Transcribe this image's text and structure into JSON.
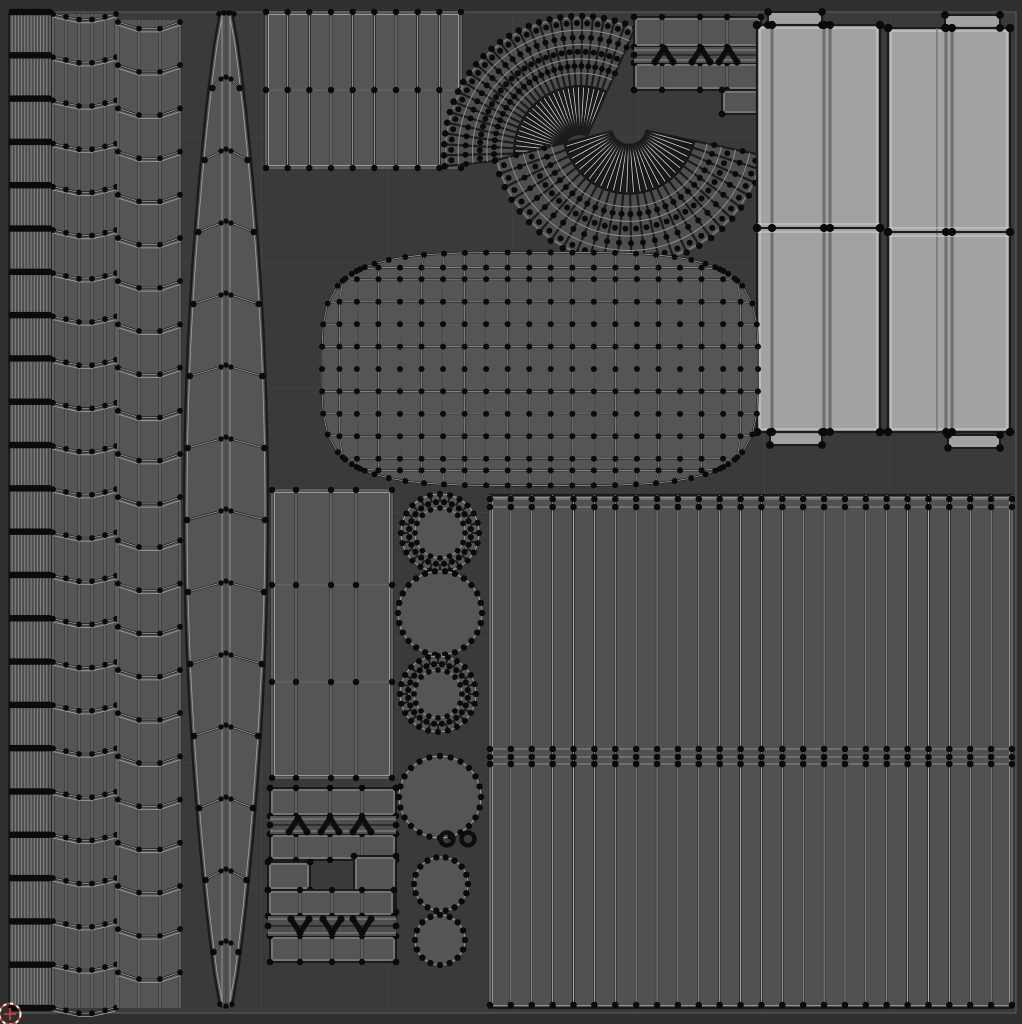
{
  "view": {
    "width": 1022,
    "height": 1024,
    "kind": "uv-editor-wireframe-viewport"
  },
  "colors": {
    "bg_outer": "#2f2f2f",
    "bg_uv": "#3a3a3a",
    "grid": "#414141",
    "uv_border": "#5e5e5e",
    "fill": "#555555",
    "fill_dim": "#4e4e4e",
    "fill_light": "#a2a2a2",
    "wire_light": "#a3a3a3",
    "wire_faint": "#8b8b8b",
    "wire_dark": "#1b1b1b",
    "vertex": "#0a0a0a",
    "band_black": "#0b0b0b",
    "fan_black": "#151515",
    "slit_light": "#d6d6d6",
    "cursor_red": "#cf3b3b",
    "cursor_white": "#efefef"
  },
  "grid": {
    "divisions": 8,
    "x": 10,
    "y": 12,
    "w": 1006,
    "h": 1001
  },
  "cursor": {
    "x": 10,
    "y": 1014,
    "r": 10.5
  },
  "islands": [
    {
      "name": "uv-island-strip-dense",
      "type": "dense_strip",
      "x": 9,
      "y": 12,
      "w": 41,
      "h": 996,
      "vlines": 12,
      "bands": 24
    },
    {
      "name": "uv-island-strip-chevron-a",
      "type": "chevron_strip",
      "y": 14,
      "h": 994,
      "cols": [
        53,
        66,
        79,
        92,
        105,
        116
      ],
      "rows": 24,
      "pitch": 43.2,
      "dip": 7,
      "off": 0
    },
    {
      "name": "uv-island-strip-chevron-b",
      "type": "chevron_strip",
      "y": 20,
      "h": 988,
      "cols": [
        118,
        139,
        160,
        180
      ],
      "rows": 23,
      "pitch": 43.2,
      "dip": 10,
      "off": 2
    },
    {
      "name": "uv-island-blade",
      "type": "blade",
      "cx": 226,
      "top": 12,
      "bottom": 1006,
      "maxHW": 42,
      "rows": 13
    },
    {
      "name": "uv-island-block-top",
      "type": "grid_block",
      "x": 266,
      "y": 12,
      "w": 195,
      "h": 156,
      "colCount": 10,
      "rowYs": [
        12,
        90,
        168
      ]
    },
    {
      "name": "uv-island-fan-upper",
      "type": "fan",
      "cx": 580,
      "cy": 152,
      "rIn": 17,
      "rOut": 136,
      "a1": -186,
      "a2": -66,
      "spokes": 26
    },
    {
      "name": "uv-island-fan-lower",
      "type": "fan",
      "cx": 629,
      "cy": 127,
      "rIn": 17,
      "rOut": 138,
      "a1": 12,
      "a2": 166,
      "spokes": 26
    },
    {
      "name": "uv-island-arrow-cluster-top",
      "type": "arrow_cluster",
      "cells": [
        {
          "x": 634,
          "y": 17,
          "w": 127,
          "h": 30,
          "v": [
            662,
            700,
            727
          ]
        },
        {
          "x": 634,
          "y": 63,
          "w": 127,
          "h": 27,
          "v": [
            662,
            700,
            727
          ]
        },
        {
          "x": 722,
          "y": 90,
          "w": 40,
          "h": 24,
          "v": []
        }
      ],
      "bands": [
        {
          "x": 634,
          "y": 47,
          "w": 127,
          "h": 16,
          "arrows": [
            664,
            701,
            728
          ],
          "dir": "up"
        }
      ]
    },
    {
      "name": "uv-island-panel-group-left",
      "type": "panels",
      "x": 757,
      "y": 25,
      "w": 123,
      "h": 407,
      "div": 228,
      "cols": [
        [
          772,
          1
        ],
        [
          824,
          1
        ],
        [
          830,
          1
        ]
      ],
      "capT": [
        768,
        12,
        54,
        13
      ],
      "capB": [
        770,
        432,
        52,
        13
      ]
    },
    {
      "name": "uv-island-panel-group-right",
      "type": "panels",
      "x": 888,
      "y": 28,
      "w": 122,
      "h": 404,
      "div": 232,
      "cols": [
        [
          937,
          0
        ],
        [
          946,
          1
        ],
        [
          952,
          1
        ]
      ],
      "capT": [
        945,
        15,
        55,
        13
      ],
      "capB": [
        948,
        435,
        52,
        13
      ]
    },
    {
      "name": "uv-island-grid-shell",
      "type": "blob",
      "cx": 540,
      "cy": 369,
      "w": 436,
      "h": 233
    },
    {
      "name": "uv-island-stack-mid",
      "type": "grid_block",
      "x": 272,
      "y": 490,
      "w": 120,
      "h": 288,
      "cols": [
        272,
        296,
        331,
        356,
        392
      ],
      "rowYs": [
        490,
        585,
        682,
        778
      ]
    },
    {
      "name": "uv-island-arrow-cluster-bottom",
      "type": "arrow_cluster",
      "cells": [
        {
          "x": 270,
          "y": 788,
          "w": 126,
          "h": 28,
          "v": [
            296,
            330,
            362
          ]
        },
        {
          "x": 270,
          "y": 834,
          "w": 126,
          "h": 26,
          "v": [
            296,
            330,
            362
          ]
        },
        {
          "x": 268,
          "y": 862,
          "w": 42,
          "h": 28,
          "v": []
        },
        {
          "x": 354,
          "y": 856,
          "w": 42,
          "h": 56,
          "v": []
        },
        {
          "x": 268,
          "y": 890,
          "w": 126,
          "h": 26,
          "v": [
            300,
            332,
            362
          ]
        },
        {
          "x": 270,
          "y": 936,
          "w": 126,
          "h": 26,
          "v": [
            300,
            332,
            362
          ]
        }
      ],
      "bands": [
        {
          "x": 270,
          "y": 816,
          "w": 126,
          "h": 18,
          "arrows": [
            298,
            330,
            362
          ],
          "dir": "up"
        },
        {
          "x": 268,
          "y": 916,
          "w": 128,
          "h": 20,
          "arrows": [
            300,
            332,
            362
          ],
          "dir": "down"
        }
      ]
    },
    {
      "name": "uv-island-block-bottom-right",
      "type": "big_striped",
      "x": 490,
      "y": 495,
      "w": 522,
      "h": 513,
      "stripes": 25,
      "bandTop": [
        499,
        507
      ],
      "bandMid": [
        749,
        757,
        764
      ],
      "bandBot": [
        1005
      ]
    },
    {
      "name": "uv-island-circles",
      "type": "circles",
      "items": [
        {
          "k": "donut",
          "cx": 440,
          "cy": 533,
          "r": 39,
          "hole": 25
        },
        {
          "k": "disc",
          "cx": 440,
          "cy": 613,
          "r": 42,
          "dots": 26
        },
        {
          "k": "donut",
          "cx": 438,
          "cy": 694,
          "r": 38,
          "hole": 24
        },
        {
          "k": "disc",
          "cx": 440,
          "cy": 797,
          "r": 41,
          "dots": 24
        },
        {
          "k": "ring",
          "cx": 447,
          "cy": 839,
          "r": 6.5
        },
        {
          "k": "ring",
          "cx": 468,
          "cy": 839,
          "r": 6.5
        },
        {
          "k": "disc",
          "cx": 441,
          "cy": 884,
          "r": 27,
          "dots": 18
        },
        {
          "k": "disc",
          "cx": 440,
          "cy": 940,
          "r": 25,
          "dots": 16
        }
      ]
    }
  ]
}
